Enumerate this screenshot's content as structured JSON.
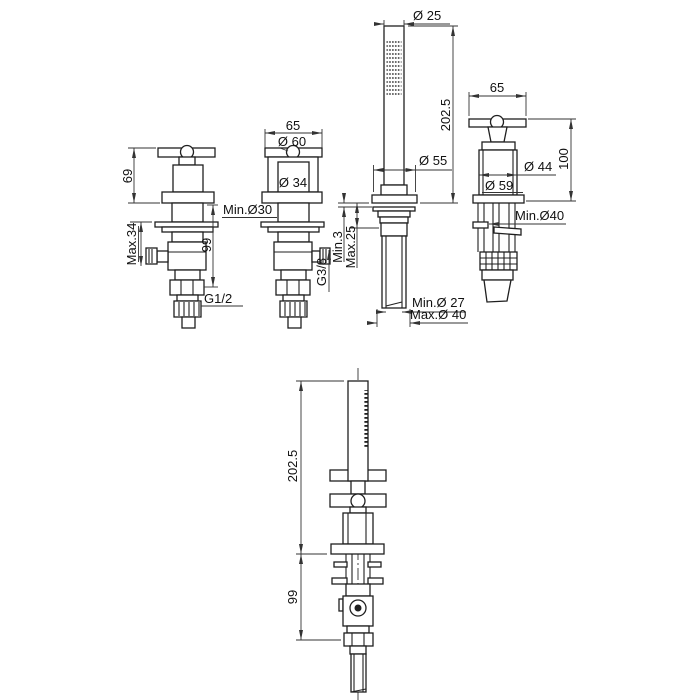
{
  "drawing": {
    "background": "#ffffff",
    "line_color": "#1f1f1f",
    "dim_color": "#333333",
    "figures": {
      "valve_front_g12": {
        "height_above_deck": "69",
        "max_deck_thickness": "Max.34",
        "depth_below_deck": "99",
        "inlet_thread": "G1/2"
      },
      "valve_front_g38": {
        "handle_width": "65",
        "handle_diameter": "Ø 60",
        "body_diameter": "Ø 34",
        "min_hole_diameter": "Min.Ø30",
        "outlet_thread": "G3/8"
      },
      "handshower_front": {
        "wand_diameter": "Ø 25",
        "height_above_deck": "202.5",
        "escutcheon_diameter": "Ø 55",
        "min_deck_thickness": "Min.3",
        "max_deck_thickness": "Max.25",
        "min_hole_diameter": "Min.Ø 27",
        "max_hole_diameter": "Max.Ø 40"
      },
      "valve_perspective": {
        "handle_width": "65",
        "height_above_deck": "100",
        "body_diameter": "Ø 44",
        "flange_diameter": "Ø 59",
        "min_hole_diameter": "Min.Ø40"
      },
      "handshower_side": {
        "height_above_deck": "202.5",
        "depth_below_deck": "99"
      }
    }
  }
}
